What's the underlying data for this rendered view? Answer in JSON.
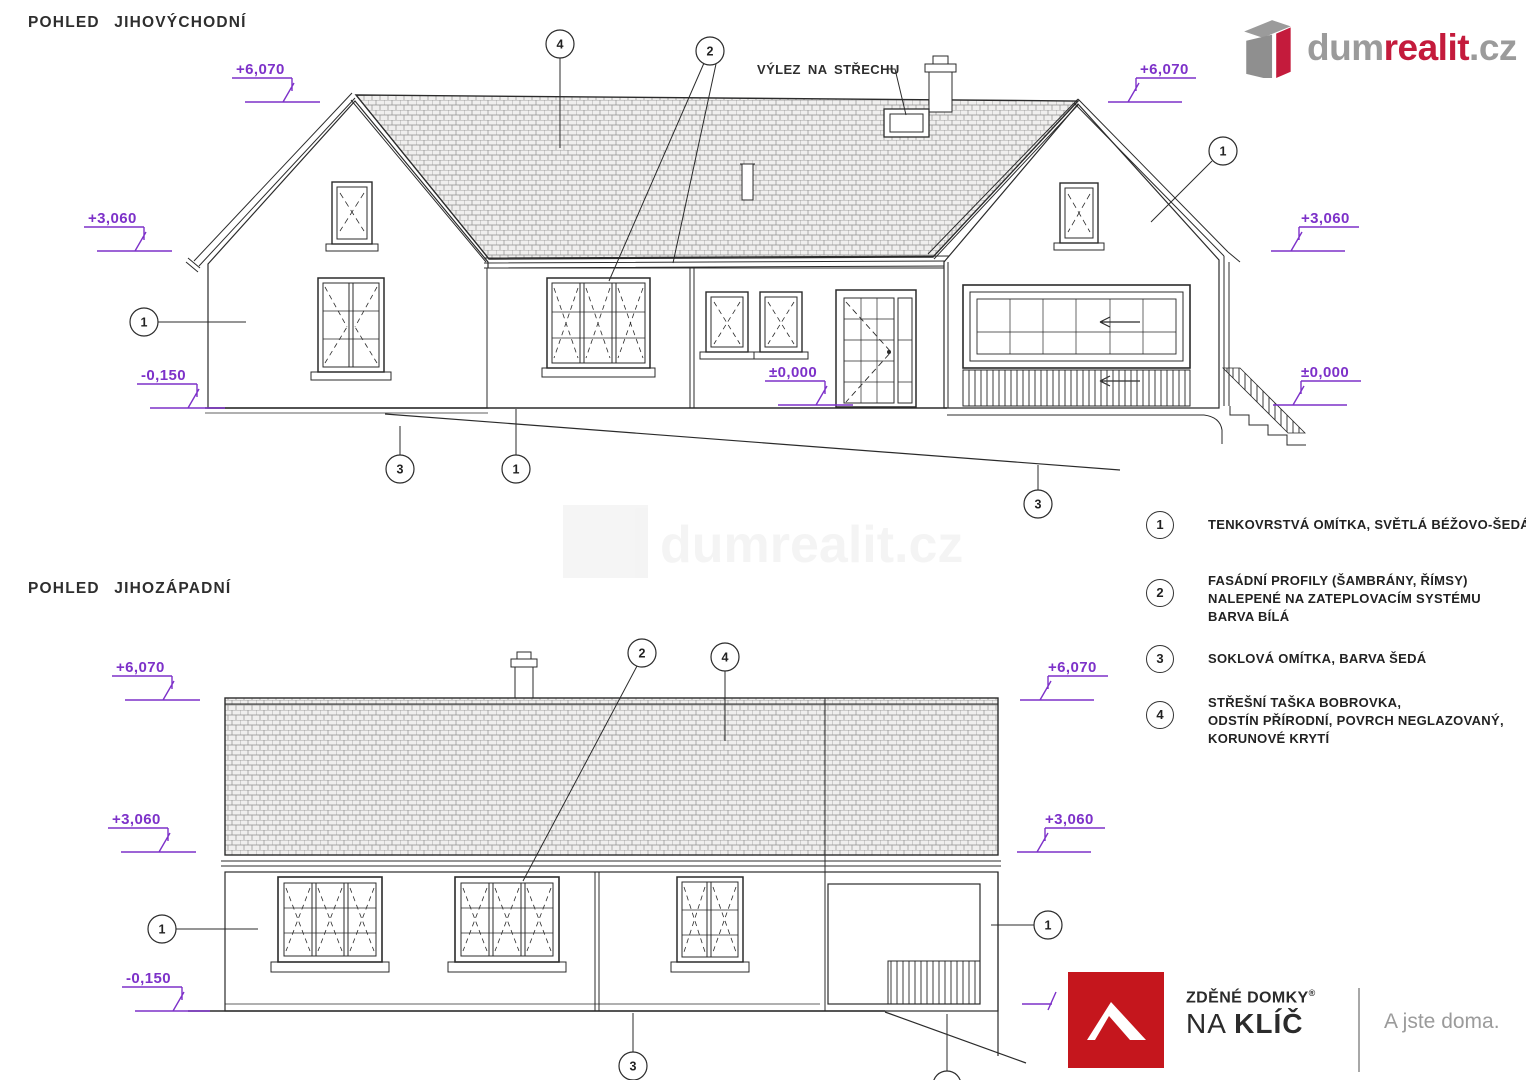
{
  "page": {
    "title_top": "POHLED JIHOVÝCHODNÍ",
    "title_bottom": "POHLED JIHOZÁPADNÍ"
  },
  "levels": {
    "ridge": "+6,070",
    "eave": "+3,060",
    "floor": "±0,000",
    "ground": "-0,150"
  },
  "annotations": {
    "roof_access": "VÝLEZ NA STŘECHU"
  },
  "callouts": {
    "c1": "1",
    "c2": "2",
    "c3": "3",
    "c4": "4"
  },
  "legend": {
    "items": [
      {
        "number": "1",
        "lines": [
          "TENKOVRSTVÁ OMÍTKA, SVĚTLÁ BÉŽOVO-ŠEDÁ"
        ]
      },
      {
        "number": "2",
        "lines": [
          "FASÁDNÍ PROFILY (ŠAMBRÁNY, ŘÍMSY)",
          "NALEPENÉ NA ZATEPLOVACÍM SYSTÉMU",
          "BARVA BÍLÁ"
        ]
      },
      {
        "number": "3",
        "lines": [
          "SOKLOVÁ OMÍTKA, BARVA ŠEDÁ"
        ]
      },
      {
        "number": "4",
        "lines": [
          "STŘEŠNÍ TAŠKA BOBROVKA,",
          "ODSTÍN PŘÍRODNÍ, POVRCH NEGLAZOVANÝ,",
          "KORUNOVÉ KRYTÍ"
        ]
      }
    ]
  },
  "branding": {
    "dumrealit": {
      "part1": "dum",
      "part2": "realit",
      "part3": ".cz"
    },
    "zdene": {
      "line1_a": "ZDĚNÉ ",
      "line1_b": "DOMKY",
      "reg": "®",
      "line2_a": "NA ",
      "line2_b": "KLÍČ",
      "tagline": "A jste doma."
    }
  },
  "watermark": {
    "text": "dumrealit.cz"
  },
  "colors": {
    "line": "#2b2b2b",
    "purple": "#7d31c9",
    "accent_red": "#c41b3c",
    "logo_red": "#c5161d",
    "gray": "#9b9b9b"
  }
}
